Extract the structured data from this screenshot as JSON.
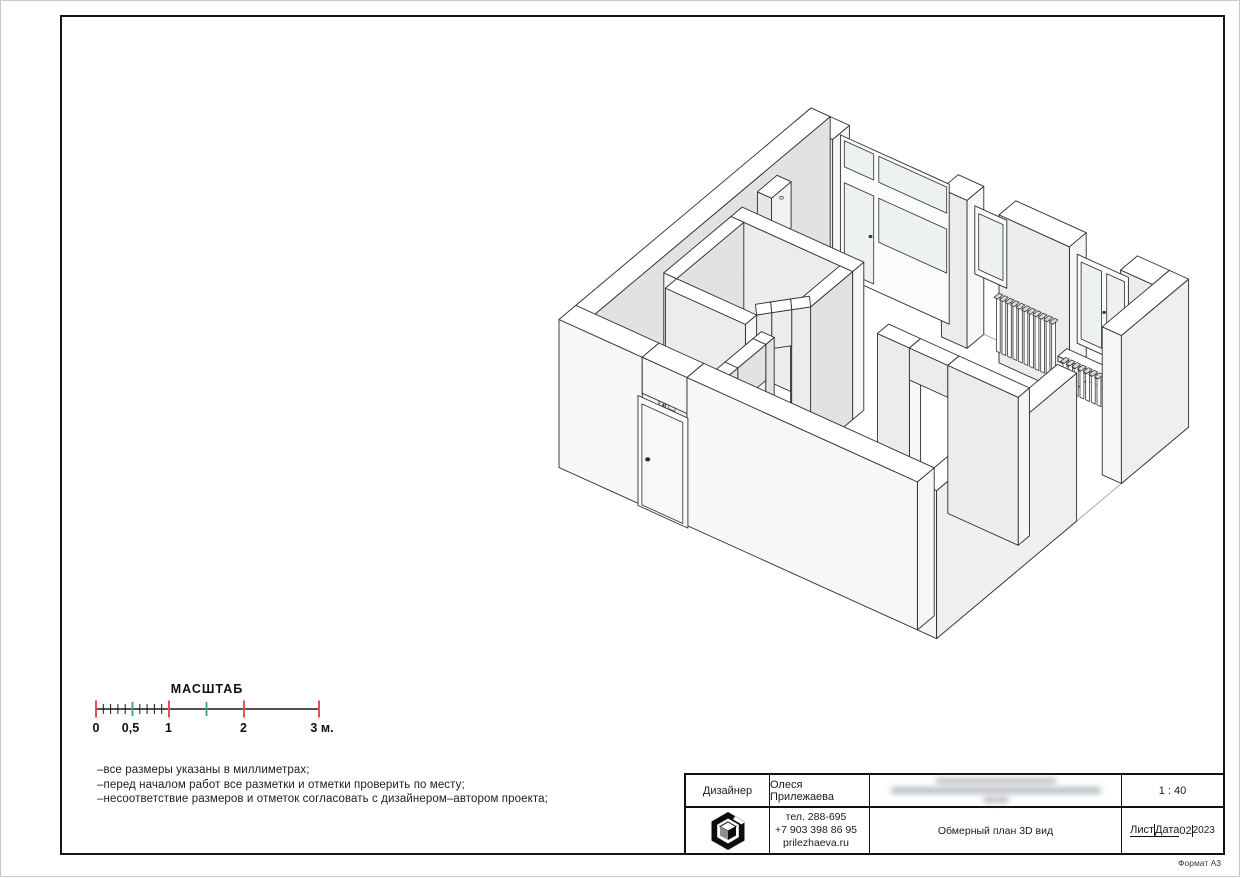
{
  "page": {
    "format_label": "Формат А3"
  },
  "scale_bar": {
    "title": "МАСШТАБ",
    "labels": [
      "0",
      "0,5",
      "1",
      "2",
      "3 м."
    ],
    "colors": {
      "major_tick": "#e0514f",
      "half_tick": "#3fa46a",
      "minor_tick": "#1a1a1a"
    }
  },
  "notes": {
    "lines": [
      "–все размеры указаны в миллиметрах;",
      "–перед началом работ все разметки и отметки проверить по месту;",
      "–несоответствие размеров и отметок согласовать с дизайнером–автором проекта;"
    ]
  },
  "title_block": {
    "designer_label": "Дизайнер",
    "designer_name": "Олеся Прилежаева",
    "address_redacted": true,
    "scale_value": "1 : 40",
    "contact": {
      "phone_short": "тел. 288-695",
      "phone_mobile": "+7 903 398 86 95",
      "website": "prilezhaeva.ru"
    },
    "drawing_title": "Обмерный план 3D вид",
    "sheet_label": "Лист",
    "date_label": "Дата",
    "sheet_number": "02",
    "date_value": "2023"
  }
}
